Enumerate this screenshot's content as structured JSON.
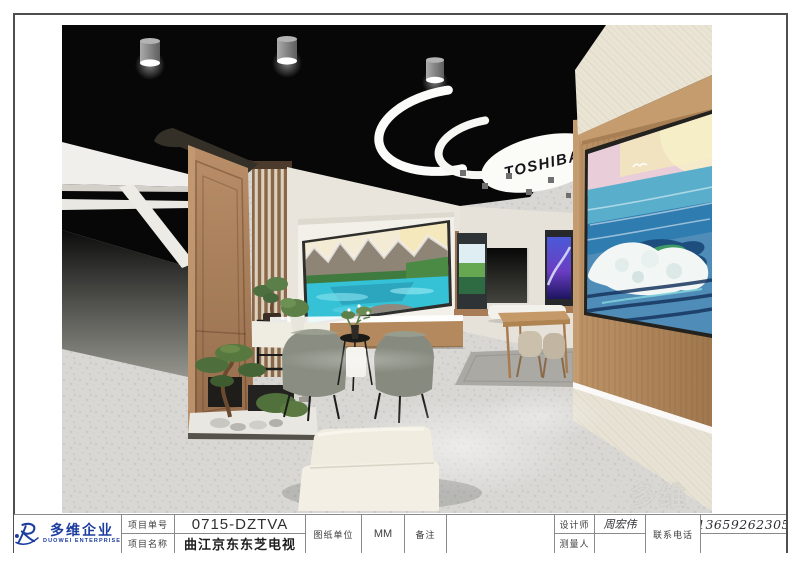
{
  "company": {
    "name_cn": "多维企业",
    "name_en": "DUOWEI ENTERPRISE",
    "brand_blue": "#1c3c9e"
  },
  "watermark": {
    "text": "多维"
  },
  "title_block": {
    "project_no_label": "项目单号",
    "project_no_value": "0715-DZTVA",
    "project_name_label": "项目名称",
    "project_name_value": "曲江京东东芝电视",
    "unit_label": "图纸单位",
    "unit_value": "MM",
    "remark_label": "备注",
    "remark_value": "",
    "designer_label": "设计师",
    "designer_value": "周宏伟",
    "surveyor_label": "测量人",
    "surveyor_value": "",
    "phone_label": "联系电话",
    "phone_value": "13659262305"
  },
  "rendering": {
    "brand_sign_text": "TOSHIBA"
  }
}
